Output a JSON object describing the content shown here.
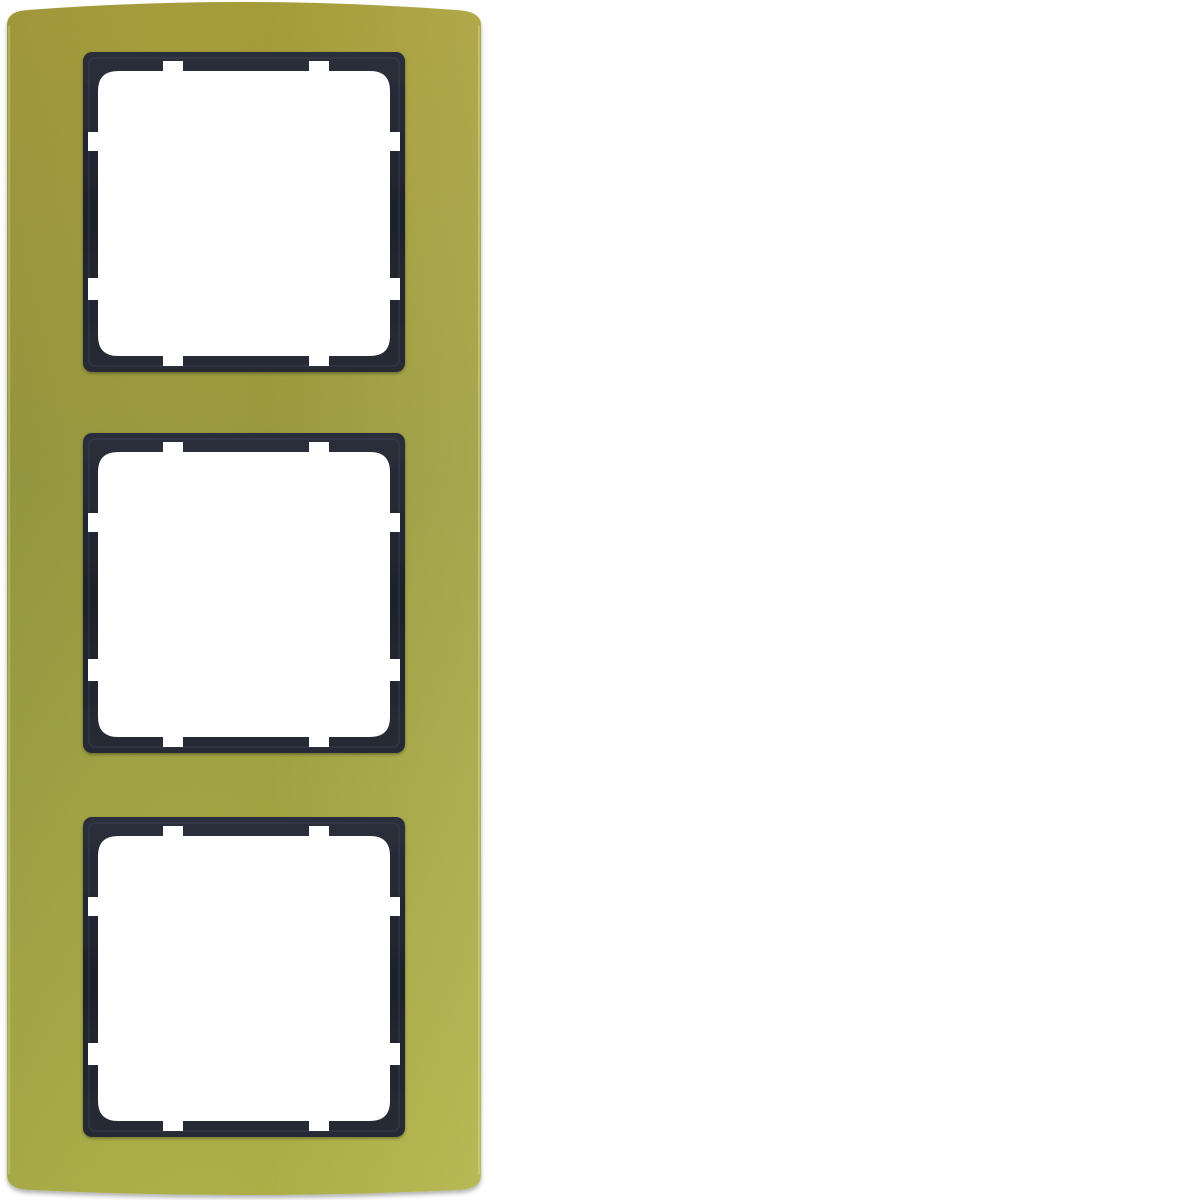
{
  "image": {
    "description": "Product photo: 3-gang cover frame, gold aluminium outer frame with anthracite inner frames on white background",
    "gangs": 3
  },
  "colors": {
    "background": "#ffffff",
    "gold_top": "#a49a35",
    "gold_mid": "#97983a",
    "gold_bottom": "#abae42",
    "gold_sheen": "#ffffb4",
    "edge_highlight": "#e4e6b4",
    "anthracite_light": "#2b2f3b",
    "anthracite": "#1e222b",
    "anthracite_low": "#272b35",
    "anthracite_bevel": "#434a5a",
    "opening": "#ffffff",
    "shadow": "#4a4a4a"
  },
  "windows": [
    {
      "label": "window-1"
    },
    {
      "label": "window-2"
    },
    {
      "label": "window-3"
    }
  ]
}
